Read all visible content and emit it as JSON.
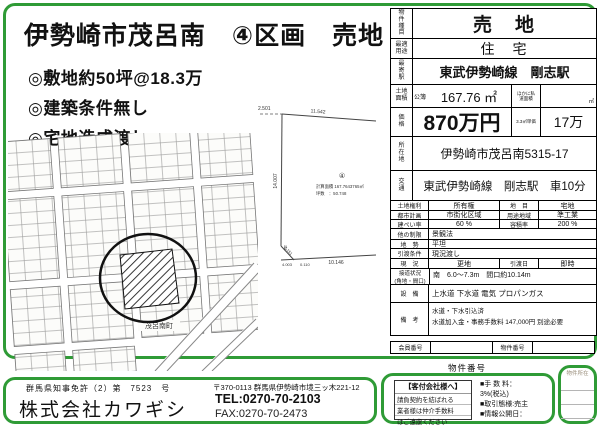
{
  "title": "伊勢崎市茂呂南　④区画　売地",
  "bullets": [
    "◎敷地約50坪@18.3万",
    "◎建築条件無し",
    "◎宅地造成渡し"
  ],
  "map": {
    "town_label": "茂呂南町"
  },
  "survey": {
    "lot_no": "④",
    "area_line": "計算面積 167.7643765㎡",
    "tsubo_line": "坪数　：50.748",
    "dim_top_offset": "2.501",
    "dim_top": "11.542",
    "dim_left": "14.007",
    "dim_tick": "111",
    "dim_diag": "2.151",
    "dim_b1": "4.003",
    "dim_b2": "0.110",
    "dim_bottom": "10.146"
  },
  "table": {
    "type": {
      "label": "物件種目",
      "value": "売　地"
    },
    "use": {
      "label": "最適用途",
      "value": "住　宅"
    },
    "station": {
      "label": "最寄駅",
      "value": "東武伊勢崎線　剛志駅"
    },
    "area": {
      "label": "土地面積",
      "register": "公簿",
      "value": "167.76 ㎡",
      "other_label": "ほかに私道面積",
      "other_unit": "㎡"
    },
    "price": {
      "label": "価格",
      "value": "870万円",
      "unit_label": "3.3㎡単価",
      "unit_value": "17万"
    },
    "address": {
      "label": "所在地",
      "value": "伊勢崎市茂呂南5315-17"
    },
    "access": {
      "label": "交通",
      "value": "東武伊勢崎線　剛志駅　車10分"
    },
    "rows4": [
      {
        "l1": "土地権利",
        "v1": "所有権",
        "l2": "地　目",
        "v2": "宅地"
      },
      {
        "l1": "都市計画",
        "v1": "市街化区域",
        "l2": "用途地域",
        "v2": "準工業"
      },
      {
        "l1": "建ぺい率",
        "v1": "60 %",
        "l2": "容積率",
        "v2": "200 %"
      }
    ],
    "restriction": {
      "label": "他の制限",
      "value": "景観法"
    },
    "terrain": {
      "label": "地　勢",
      "value": "平坦"
    },
    "cond": {
      "label": "引渡条件",
      "value": "現況渡し"
    },
    "status": {
      "label": "現　況",
      "value": "更地",
      "l2": "引渡日",
      "v2": "即時"
    },
    "road": {
      "label1": "接道状況",
      "label2": "(角地・間口)",
      "value": "南　6.0～7.3m　間口約10.14m"
    },
    "facility": {
      "label": "設　備",
      "value": "上水道 下水道 電気 プロパンガス"
    },
    "remarks": {
      "label": "備　考",
      "line1": "水道・下水引込済",
      "line2": "水道加入金・事務手数料 147,000円 別途必要"
    },
    "member": {
      "label1": "会員番号",
      "label2": "物件番号"
    }
  },
  "bottom": {
    "bukken_no_label": "物件番号",
    "partner": {
      "heading": "【客付会社様へ】",
      "line1": "請負契約を結ばれる",
      "line2": "業者様は仲介手数料",
      "line3": "はご遠慮ください",
      "fee_label": "■手 数 料：",
      "fee_value": "3%(税込)",
      "deal": "■取引態様:売主",
      "publish": "■情報公開日："
    },
    "location_label": "物件所在"
  },
  "company": {
    "license": "群馬県知事免許（2）第　7523　号",
    "name": "株式会社カワギシ",
    "address": "〒370-0113 群馬県伊勢崎市境三ッ木221-12",
    "tel": "TEL:0270-70-2103",
    "fax": "FAX:0270-70-2473"
  },
  "colors": {
    "frame_green": "#2f9b36"
  }
}
